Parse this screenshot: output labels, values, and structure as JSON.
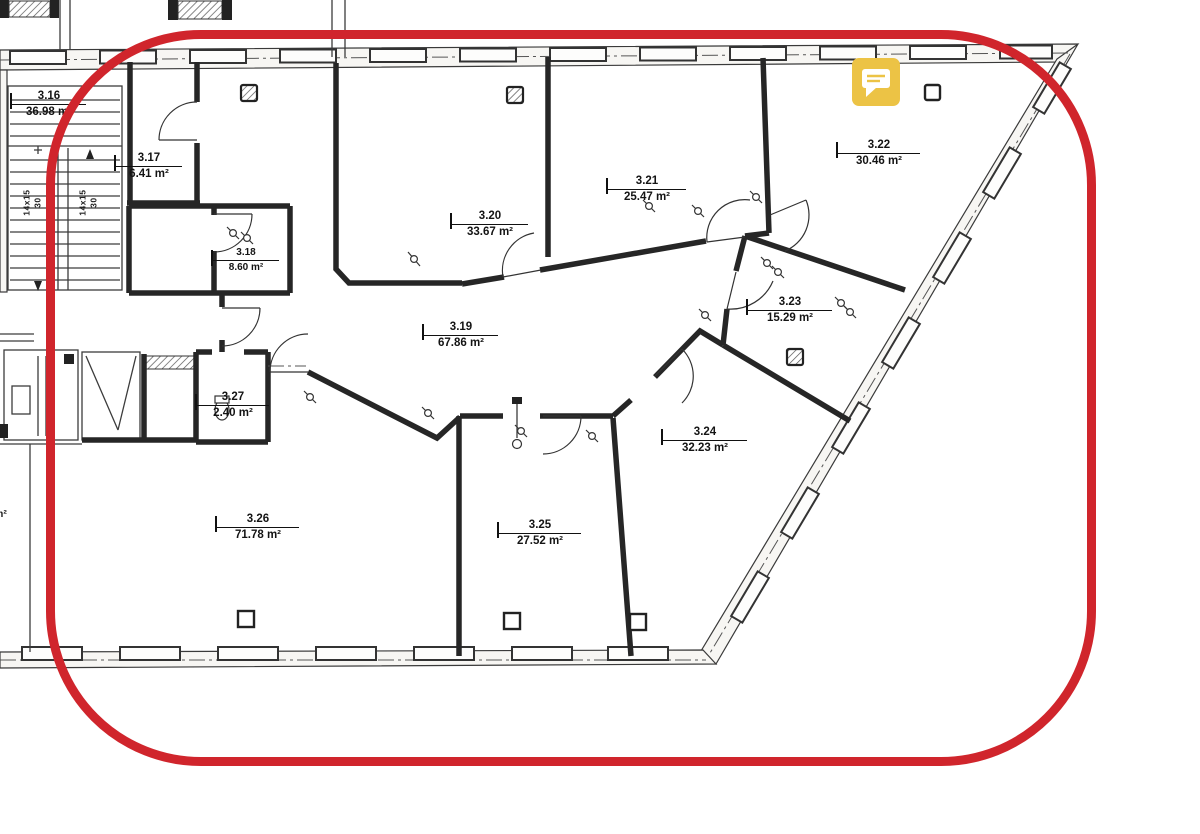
{
  "colors": {
    "highlight_red": "#d0252c",
    "comment_yellow": "#ecc345",
    "wall_ink": "#262626"
  },
  "rooms": [
    {
      "number": "3.16",
      "area": "36.98 m²"
    },
    {
      "number": "3.17",
      "area": "6.41 m²"
    },
    {
      "number": "3.18",
      "area": "8.60 m²"
    },
    {
      "number": "3.19",
      "area": "67.86 m²"
    },
    {
      "number": "3.20",
      "area": "33.67 m²"
    },
    {
      "number": "3.21",
      "area": "25.47 m²"
    },
    {
      "number": "3.22",
      "area": "30.46 m²"
    },
    {
      "number": "3.23",
      "area": "15.29 m²"
    },
    {
      "number": "3.24",
      "area": "32.23 m²"
    },
    {
      "number": "3.25",
      "area": "27.52 m²"
    },
    {
      "number": "3.26",
      "area": "71.78 m²"
    },
    {
      "number": "3.27",
      "area": "2.40 m²"
    }
  ],
  "stairs": {
    "flights": [
      {
        "steps": "14x15",
        "rise": "30"
      },
      {
        "steps": "14x15",
        "rise": "30"
      }
    ]
  },
  "partial_label": "m²"
}
